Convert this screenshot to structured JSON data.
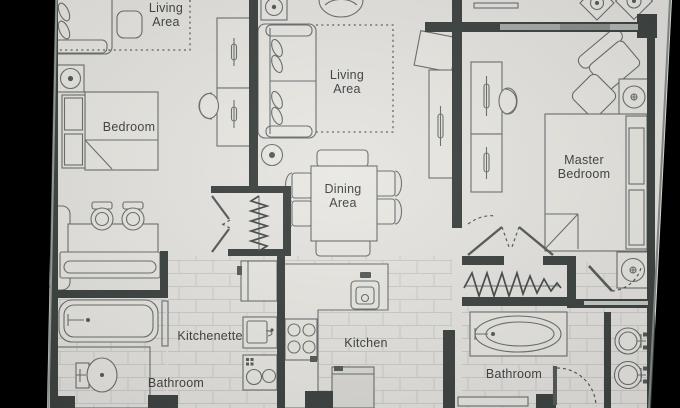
{
  "colors": {
    "bezel": "#0b0c0e",
    "floor_paper": "#e7e5e1",
    "wall": "#3e4442",
    "furniture_line": "#6a706f",
    "tile_line": "#cbc9c3",
    "window_glass": "#a8ada9",
    "label_text": "#3f4443"
  },
  "rooms": {
    "living_area_left": {
      "label": "Living\nArea"
    },
    "bedroom_left": {
      "label": "Bedroom"
    },
    "living_area_middle": {
      "label": "Living\nArea"
    },
    "dining_area": {
      "label": "Dining\nArea"
    },
    "kitchen": {
      "label": "Kitchen"
    },
    "kitchenette": {
      "label": "Kitchenette"
    },
    "bathroom_left": {
      "label": "Bathroom"
    },
    "master_bedroom": {
      "label": "Master\nBedroom"
    },
    "master_bathroom": {
      "label": "Bathroom"
    }
  },
  "furniture_symbols": [
    "sofa",
    "side-table",
    "table-lamp",
    "bed",
    "nightstand",
    "headboard-shelves",
    "desk",
    "desk-chair",
    "dresser",
    "tv-console",
    "armchair",
    "ottoman",
    "dining-table",
    "dining-chair",
    "dining-bench",
    "round-table",
    "kitchen-counter",
    "kitchen-sink",
    "cooktop-4-burner",
    "refrigerator",
    "kitchenette-cabinet",
    "kitchenette-sink",
    "cooktop-2-burner",
    "vanity-with-sinks",
    "bathtub",
    "oval-bathtub",
    "toilet",
    "bathroom-sink",
    "closet-hanging-rod",
    "bifold-door",
    "door-swing",
    "window"
  ]
}
